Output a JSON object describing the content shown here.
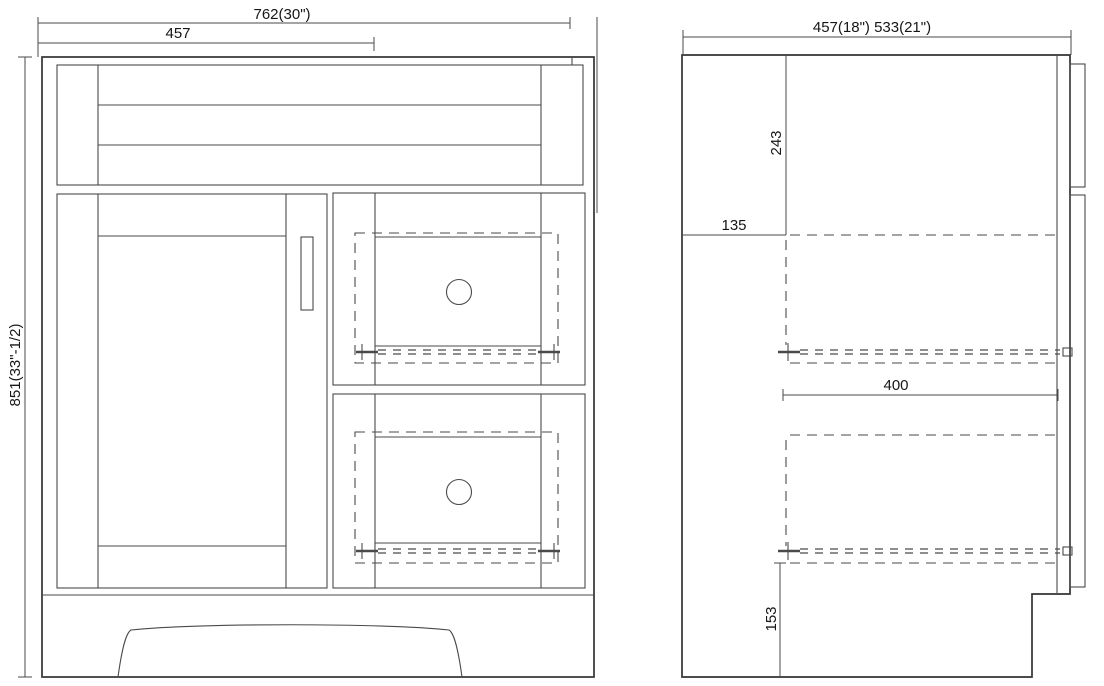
{
  "front_view": {
    "dim_width": "762(30\")",
    "dim_door_width": "457",
    "dim_height": "851(33\"-1/2)"
  },
  "side_view": {
    "dim_depth": "457(18\")  533(21\")",
    "dim_top_to_drawer": "243",
    "dim_back_offset": "135",
    "dim_slide_length": "400",
    "dim_bottom_offset": "153"
  },
  "colors": {
    "background": "#ffffff",
    "line": "#4a4a4a",
    "bold_line": "#333333",
    "text": "#161616"
  }
}
